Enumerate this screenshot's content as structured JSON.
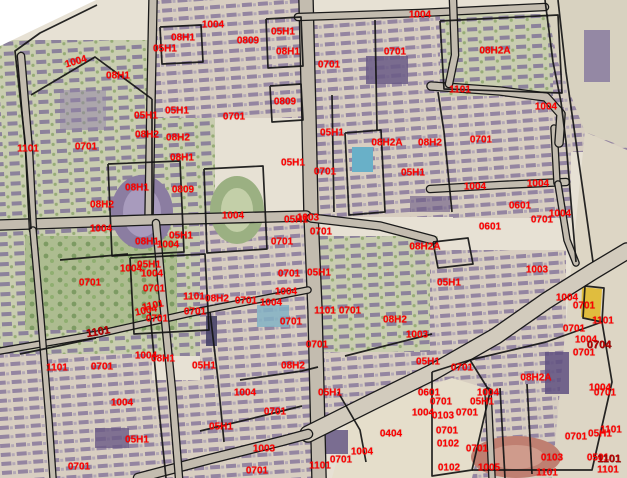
{
  "map": {
    "width": 627,
    "height": 478,
    "label_color": "#ff0000",
    "bold_label_color": "#b80000",
    "boundary_color": "#141414",
    "road_fill_color": "#c3bcaf",
    "base_color": "#e7e1d4",
    "labels": [
      {
        "text": "1004",
        "x": 76,
        "y": 62,
        "r": -16
      },
      {
        "text": "08H1",
        "x": 118,
        "y": 76
      },
      {
        "text": "05H1",
        "x": 165,
        "y": 49
      },
      {
        "text": "08H1",
        "x": 183,
        "y": 38
      },
      {
        "text": "1004",
        "x": 213,
        "y": 25
      },
      {
        "text": "0809",
        "x": 248,
        "y": 41
      },
      {
        "text": "05H1",
        "x": 283,
        "y": 32
      },
      {
        "text": "08H1",
        "x": 288,
        "y": 52
      },
      {
        "text": "0701",
        "x": 329,
        "y": 65
      },
      {
        "text": "1004",
        "x": 420,
        "y": 15
      },
      {
        "text": "0701",
        "x": 395,
        "y": 52
      },
      {
        "text": "08H2A",
        "x": 495,
        "y": 51
      },
      {
        "text": "1101",
        "x": 460,
        "y": 90
      },
      {
        "text": "1004",
        "x": 546,
        "y": 107
      },
      {
        "text": "0809",
        "x": 285,
        "y": 102
      },
      {
        "text": "05H1",
        "x": 177,
        "y": 111
      },
      {
        "text": "05H1",
        "x": 146,
        "y": 116
      },
      {
        "text": "0701",
        "x": 234,
        "y": 117
      },
      {
        "text": "1101",
        "x": 28,
        "y": 149
      },
      {
        "text": "0701",
        "x": 86,
        "y": 147
      },
      {
        "text": "08H2",
        "x": 147,
        "y": 135
      },
      {
        "text": "08H2",
        "x": 178,
        "y": 138
      },
      {
        "text": "05H1",
        "x": 332,
        "y": 133
      },
      {
        "text": "08H2A",
        "x": 387,
        "y": 143
      },
      {
        "text": "08H2",
        "x": 430,
        "y": 143
      },
      {
        "text": "0701",
        "x": 481,
        "y": 140
      },
      {
        "text": "08H1",
        "x": 182,
        "y": 158
      },
      {
        "text": "05H1",
        "x": 293,
        "y": 163
      },
      {
        "text": "0701",
        "x": 325,
        "y": 172
      },
      {
        "text": "05H1",
        "x": 413,
        "y": 173
      },
      {
        "text": "08H1",
        "x": 137,
        "y": 188
      },
      {
        "text": "0809",
        "x": 183,
        "y": 190
      },
      {
        "text": "1004",
        "x": 475,
        "y": 187
      },
      {
        "text": "1004",
        "x": 538,
        "y": 184
      },
      {
        "text": "08H2",
        "x": 102,
        "y": 205
      },
      {
        "text": "0601",
        "x": 520,
        "y": 206
      },
      {
        "text": "1004",
        "x": 560,
        "y": 214
      },
      {
        "text": "0701",
        "x": 542,
        "y": 220
      },
      {
        "text": "1004",
        "x": 233,
        "y": 216
      },
      {
        "text": "1003",
        "x": 308,
        "y": 218
      },
      {
        "text": "05H1",
        "x": 296,
        "y": 220
      },
      {
        "text": "1004",
        "x": 101,
        "y": 229
      },
      {
        "text": "0601",
        "x": 490,
        "y": 227
      },
      {
        "text": "05H1",
        "x": 181,
        "y": 236
      },
      {
        "text": "0701",
        "x": 321,
        "y": 232
      },
      {
        "text": "08H1",
        "x": 147,
        "y": 242
      },
      {
        "text": "1004",
        "x": 168,
        "y": 245
      },
      {
        "text": "0701",
        "x": 282,
        "y": 242
      },
      {
        "text": "08H2A",
        "x": 425,
        "y": 247
      },
      {
        "text": "05H1",
        "x": 149,
        "y": 265
      },
      {
        "text": "1004",
        "x": 131,
        "y": 269
      },
      {
        "text": "1003",
        "x": 537,
        "y": 270
      },
      {
        "text": "0701",
        "x": 289,
        "y": 274
      },
      {
        "text": "05H1",
        "x": 319,
        "y": 273
      },
      {
        "text": "1004",
        "x": 152,
        "y": 274
      },
      {
        "text": "0701",
        "x": 90,
        "y": 283
      },
      {
        "text": "05H1",
        "x": 449,
        "y": 283
      },
      {
        "text": "0701",
        "x": 154,
        "y": 289
      },
      {
        "text": "1004",
        "x": 286,
        "y": 292
      },
      {
        "text": "1101",
        "x": 194,
        "y": 297
      },
      {
        "text": "1004",
        "x": 567,
        "y": 298
      },
      {
        "text": "08H2",
        "x": 217,
        "y": 299
      },
      {
        "text": "0701",
        "x": 246,
        "y": 301
      },
      {
        "text": "1004",
        "x": 271,
        "y": 303
      },
      {
        "text": "1101",
        "x": 153,
        "y": 306,
        "r": -12
      },
      {
        "text": "0701",
        "x": 584,
        "y": 306
      },
      {
        "text": "1101",
        "x": 325,
        "y": 311
      },
      {
        "text": "0701",
        "x": 350,
        "y": 311
      },
      {
        "text": "1004",
        "x": 146,
        "y": 311,
        "r": -12
      },
      {
        "text": "0701",
        "x": 195,
        "y": 312
      },
      {
        "text": "0701",
        "x": 157,
        "y": 319
      },
      {
        "text": "08H2",
        "x": 395,
        "y": 320
      },
      {
        "text": "1101",
        "x": 603,
        "y": 321
      },
      {
        "text": "0701",
        "x": 291,
        "y": 322
      },
      {
        "text": "0701",
        "x": 574,
        "y": 329
      },
      {
        "text": "1101",
        "x": 98,
        "y": 332,
        "bold": true,
        "r": -10
      },
      {
        "text": "1003",
        "x": 417,
        "y": 335
      },
      {
        "text": "1004",
        "x": 586,
        "y": 340
      },
      {
        "text": "0704",
        "x": 599,
        "y": 345,
        "bold": true
      },
      {
        "text": "0701",
        "x": 317,
        "y": 345
      },
      {
        "text": "0701",
        "x": 584,
        "y": 353
      },
      {
        "text": "1004",
        "x": 146,
        "y": 356
      },
      {
        "text": "08H1",
        "x": 163,
        "y": 359
      },
      {
        "text": "05H1",
        "x": 428,
        "y": 362
      },
      {
        "text": "05H1",
        "x": 204,
        "y": 366
      },
      {
        "text": "08H2",
        "x": 293,
        "y": 366
      },
      {
        "text": "1101",
        "x": 57,
        "y": 368
      },
      {
        "text": "0701",
        "x": 102,
        "y": 367
      },
      {
        "text": "0701",
        "x": 462,
        "y": 368
      },
      {
        "text": "08H2A",
        "x": 536,
        "y": 378
      },
      {
        "text": "1004",
        "x": 600,
        "y": 388
      },
      {
        "text": "0601",
        "x": 429,
        "y": 393
      },
      {
        "text": "1004",
        "x": 488,
        "y": 393
      },
      {
        "text": "05H1",
        "x": 330,
        "y": 393
      },
      {
        "text": "0701",
        "x": 605,
        "y": 393
      },
      {
        "text": "1004",
        "x": 245,
        "y": 393
      },
      {
        "text": "0701",
        "x": 441,
        "y": 402
      },
      {
        "text": "05H1",
        "x": 482,
        "y": 402
      },
      {
        "text": "1004",
        "x": 122,
        "y": 403
      },
      {
        "text": "0701",
        "x": 275,
        "y": 412
      },
      {
        "text": "1004",
        "x": 423,
        "y": 413
      },
      {
        "text": "0701",
        "x": 467,
        "y": 413
      },
      {
        "text": "0103",
        "x": 443,
        "y": 416
      },
      {
        "text": "05H1",
        "x": 221,
        "y": 427
      },
      {
        "text": "1101",
        "x": 611,
        "y": 430
      },
      {
        "text": "0701",
        "x": 447,
        "y": 431
      },
      {
        "text": "0404",
        "x": 391,
        "y": 434
      },
      {
        "text": "05H1",
        "x": 600,
        "y": 434
      },
      {
        "text": "0701",
        "x": 576,
        "y": 437
      },
      {
        "text": "05H1",
        "x": 137,
        "y": 440
      },
      {
        "text": "0102",
        "x": 448,
        "y": 444
      },
      {
        "text": "1003",
        "x": 264,
        "y": 449
      },
      {
        "text": "0701",
        "x": 477,
        "y": 449
      },
      {
        "text": "1004",
        "x": 362,
        "y": 452
      },
      {
        "text": "0103",
        "x": 552,
        "y": 458
      },
      {
        "text": "0501",
        "x": 598,
        "y": 458
      },
      {
        "text": "1101",
        "x": 609,
        "y": 459,
        "bold": true
      },
      {
        "text": "0701",
        "x": 341,
        "y": 460
      },
      {
        "text": "1101",
        "x": 320,
        "y": 466
      },
      {
        "text": "0102",
        "x": 449,
        "y": 468
      },
      {
        "text": "1005",
        "x": 489,
        "y": 468
      },
      {
        "text": "0701",
        "x": 79,
        "y": 467
      },
      {
        "text": "1101",
        "x": 608,
        "y": 470
      },
      {
        "text": "0701",
        "x": 257,
        "y": 471
      },
      {
        "text": "1101",
        "x": 547,
        "y": 473
      }
    ],
    "districts": [
      {
        "shape": "rect",
        "x": 0,
        "y": 0,
        "w": 627,
        "h": 478,
        "fill": "#e7e1d4"
      },
      {
        "shape": "rect",
        "x": 0,
        "y": 40,
        "w": 215,
        "h": 190,
        "fill": "p-bldgG"
      },
      {
        "shape": "rect",
        "x": 150,
        "y": 0,
        "w": 160,
        "h": 118,
        "fill": "p-bldg"
      },
      {
        "shape": "rect",
        "x": 305,
        "y": 12,
        "w": 152,
        "h": 205,
        "fill": "p-bldg"
      },
      {
        "shape": "rect",
        "x": 440,
        "y": 14,
        "w": 122,
        "h": 82,
        "fill": "p-bldgG"
      },
      {
        "shape": "rect",
        "x": 453,
        "y": 96,
        "w": 118,
        "h": 122,
        "fill": "p-bldg"
      },
      {
        "shape": "rect",
        "x": 553,
        "y": 0,
        "w": 74,
        "h": 152,
        "fill": "p-bldg"
      },
      {
        "shape": "rect",
        "x": 0,
        "y": 224,
        "w": 202,
        "h": 132,
        "fill": "p-bldgG"
      },
      {
        "shape": "rect",
        "x": 25,
        "y": 236,
        "w": 152,
        "h": 94,
        "fill": "p-trees"
      },
      {
        "shape": "rect",
        "x": 200,
        "y": 215,
        "w": 112,
        "h": 166,
        "fill": "p-bldg"
      },
      {
        "shape": "rect",
        "x": 312,
        "y": 236,
        "w": 126,
        "h": 146,
        "fill": "p-bldgG"
      },
      {
        "shape": "rect",
        "x": 430,
        "y": 250,
        "w": 136,
        "h": 132,
        "fill": "p-bldg"
      },
      {
        "shape": "rect",
        "x": 0,
        "y": 354,
        "w": 152,
        "h": 124,
        "fill": "p-bldg"
      },
      {
        "shape": "rect",
        "x": 150,
        "y": 380,
        "w": 168,
        "h": 98,
        "fill": "p-bldg"
      },
      {
        "shape": "rect",
        "x": 315,
        "y": 352,
        "w": 118,
        "h": 64,
        "fill": "p-bldg"
      },
      {
        "shape": "rect",
        "x": 430,
        "y": 358,
        "w": 197,
        "h": 120,
        "fill": "p-bldg"
      },
      {
        "shape": "poly",
        "pts": "545,0 627,0 627,148 585,132 558,62",
        "fill": "#d8d2c0"
      },
      {
        "shape": "poly",
        "pts": "585,132 627,150 627,478 552,478 568,300",
        "fill": "#ddd6c5"
      },
      {
        "shape": "poly",
        "pts": "350,412 452,378 492,390 472,478 332,478",
        "fill": "#e5decb"
      },
      {
        "shape": "poly",
        "pts": "0,0 96,0 0,46",
        "fill": "#ffffff"
      }
    ],
    "features": [
      {
        "shape": "rect",
        "x": 60,
        "y": 90,
        "w": 46,
        "h": 40,
        "fill": "#8f80a8",
        "op": 0.5
      },
      {
        "shape": "ellipse",
        "cx": 142,
        "cy": 212,
        "rx": 31,
        "ry": 37,
        "fill": "#8b7da1"
      },
      {
        "shape": "ellipse",
        "cx": 142,
        "cy": 212,
        "rx": 19,
        "ry": 25,
        "fill": "#a89bbd"
      },
      {
        "shape": "ellipse",
        "cx": 237,
        "cy": 210,
        "rx": 27,
        "ry": 34,
        "fill": "#9bb082"
      },
      {
        "shape": "ellipse",
        "cx": 237,
        "cy": 210,
        "rx": 16,
        "ry": 22,
        "fill": "#c3cfa8"
      },
      {
        "shape": "rect",
        "x": 352,
        "y": 147,
        "w": 21,
        "h": 25,
        "fill": "#69b0c8"
      },
      {
        "shape": "ellipse",
        "cx": 516,
        "cy": 457,
        "rx": 45,
        "ry": 21,
        "fill": "#bf7f71"
      },
      {
        "shape": "ellipse",
        "cx": 516,
        "cy": 457,
        "rx": 28,
        "ry": 12,
        "fill": "#cf9b8c"
      },
      {
        "shape": "poly",
        "pts": "582,287 602,289 600,321 581,317",
        "fill": "#e0bd3e"
      },
      {
        "shape": "rect",
        "x": 257,
        "y": 305,
        "w": 32,
        "h": 22,
        "fill": "#82b2c4",
        "op": 0.85
      },
      {
        "shape": "rect",
        "x": 366,
        "y": 56,
        "w": 42,
        "h": 28,
        "fill": "#6a5a86",
        "op": 0.85
      },
      {
        "shape": "rect",
        "x": 545,
        "y": 352,
        "w": 24,
        "h": 42,
        "fill": "#5f5080",
        "op": 0.85
      },
      {
        "shape": "rect",
        "x": 206,
        "y": 316,
        "w": 11,
        "h": 30,
        "fill": "#474368",
        "op": 0.9
      },
      {
        "shape": "rect",
        "x": 95,
        "y": 428,
        "w": 34,
        "h": 20,
        "fill": "#6a5a86",
        "op": 0.8
      },
      {
        "shape": "rect",
        "x": 322,
        "y": 430,
        "w": 26,
        "h": 24,
        "fill": "#5f5080",
        "op": 0.8
      },
      {
        "shape": "rect",
        "x": 584,
        "y": 30,
        "w": 26,
        "h": 52,
        "fill": "#776898",
        "op": 0.7
      },
      {
        "shape": "rect",
        "x": 410,
        "y": 196,
        "w": 40,
        "h": 16,
        "fill": "#6a5a86",
        "op": 0.6
      }
    ],
    "roads": [
      {
        "pts": "306,0 309,120 311,215 315,310 319,478",
        "w": 13
      },
      {
        "pts": "153,0 151,100 149,218",
        "w": 7
      },
      {
        "pts": "0,225 149,220 306,216",
        "w": 9
      },
      {
        "pts": "311,218 380,226 433,240",
        "w": 7
      },
      {
        "pts": "430,189 500,185 566,182",
        "w": 6
      },
      {
        "pts": "554,128 557,183",
        "w": 5
      },
      {
        "pts": "558,184 567,240 576,263",
        "w": 5
      },
      {
        "pts": "298,17 420,13 545,7",
        "w": 6
      },
      {
        "pts": "431,86 500,91 546,97 561,114 559,143",
        "w": 7
      },
      {
        "pts": "308,434 370,403 433,372 496,336 546,301 592,272 627,251",
        "w": 15,
        "c": "#d2cbbd"
      },
      {
        "pts": "138,478 210,459 282,441 308,434",
        "w": 8
      },
      {
        "pts": "0,351 98,334 200,311 308,290",
        "w": 5
      },
      {
        "pts": "21,56 29,150 33,230",
        "w": 6
      },
      {
        "pts": "33,230 41,320 49,420 53,478",
        "w": 5
      },
      {
        "pts": "156,223 163,300 172,390 179,478",
        "w": 6
      },
      {
        "pts": "488,391 492,478",
        "w": 5
      },
      {
        "pts": "453,0 455,55 449,84",
        "w": 6
      }
    ],
    "boundaries": [
      "97,5 40,33 15,51 25,141 31,229",
      "31,95 95,57 152,99",
      "152,99 152,215",
      "108,164 180,161 184,252 112,256 108,164",
      "204,169 263,166 267,249 207,253 204,169",
      "160,27 201,25 203,62 162,64 160,27",
      "266,19 301,17 303,66 268,68 266,19",
      "440,21 558,15 562,93 444,89 440,21",
      "345,133 381,130 385,212 349,215 345,133",
      "545,0 553,62 561,102 566,142 571,202 576,262",
      "558,0 566,72 576,142 586,212 593,262",
      "130,258 205,254 209,330 134,334 130,258",
      "433,242 468,238 473,264 438,268 433,242",
      "270,86 301,84 303,120 272,122 270,86",
      "438,92 444,132 448,172 452,212",
      "585,286 604,288 602,322 583,318 585,286",
      "432,372 470,360 490,392 472,470 432,476 432,372",
      "470,360 546,342 602,322 612,382 592,470 472,470",
      "500,388 505,478",
      "527,384 532,474",
      "150,312 158,400 166,478",
      "210,312 218,380 224,442",
      "240,380 302,371 318,367",
      "200,431 262,416 302,406",
      "345,356 432,334",
      "338,392 360,430 366,462",
      "20,354 96,338",
      "60,260 128,254",
      "332,95 334,212",
      "375,20 377,130"
    ]
  }
}
